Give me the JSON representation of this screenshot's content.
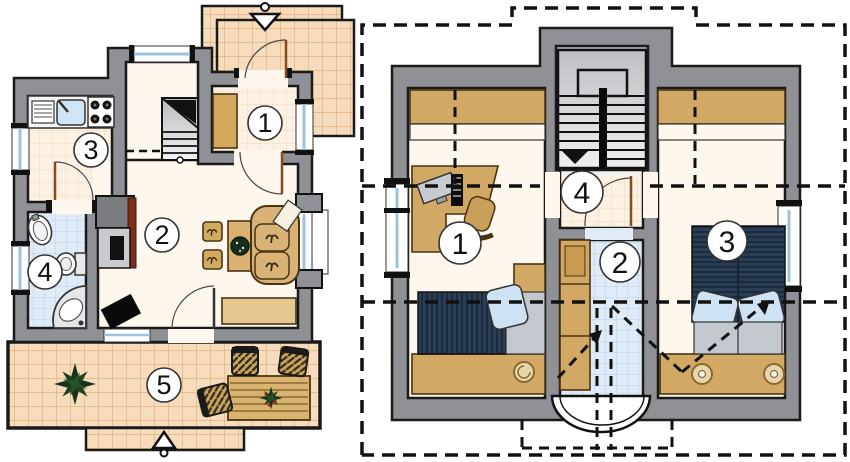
{
  "document": {
    "kind": "architectural-floor-plans",
    "plans": [
      "ground-floor",
      "upper-floor"
    ]
  },
  "ground_floor": {
    "rooms": [
      {
        "label": "1",
        "area": "entrance-hall"
      },
      {
        "label": "2",
        "area": "living-room"
      },
      {
        "label": "3",
        "area": "kitchen"
      },
      {
        "label": "4",
        "area": "bathroom"
      },
      {
        "label": "5",
        "area": "terrace"
      }
    ],
    "symbols": {
      "entry_arrow": "entrance-direction-arrow",
      "terrace_arrow": "terrace-entry-arrow",
      "stairs": "staircase-up"
    }
  },
  "upper_floor": {
    "rooms": [
      {
        "label": "1",
        "area": "bedroom-office"
      },
      {
        "label": "2",
        "area": "bathroom"
      },
      {
        "label": "3",
        "area": "bedroom"
      },
      {
        "label": "4",
        "area": "landing"
      }
    ],
    "symbols": {
      "stairs": "staircase-down-arrow",
      "roof_outline": "dashed-roof-projection"
    }
  },
  "colors": {
    "wall": "#8f9196",
    "outline": "#1a1a1a",
    "floor_cream": "#fdf7ee",
    "tile_orange": "#f6dcba",
    "tile_orange_grid": "#dba97a",
    "tile_faint": "#fcf1e3",
    "tile_faint_grid": "#efd6b4",
    "tile_blue": "#dfecf7",
    "tile_blue_grid": "#b6d0e7",
    "furniture_tan": "#d2a964",
    "furniture_outline": "#4a3410",
    "bed_navy": "#2b3e53",
    "pillow_blue": "#cfe2f3",
    "blanket_gray": "#c3c7ce",
    "glass_blue": "#cfe4f4",
    "door_leaf": "#8a4a1f",
    "fireplace_accent": "#7b2f1a",
    "plant_green": "#17331b"
  }
}
